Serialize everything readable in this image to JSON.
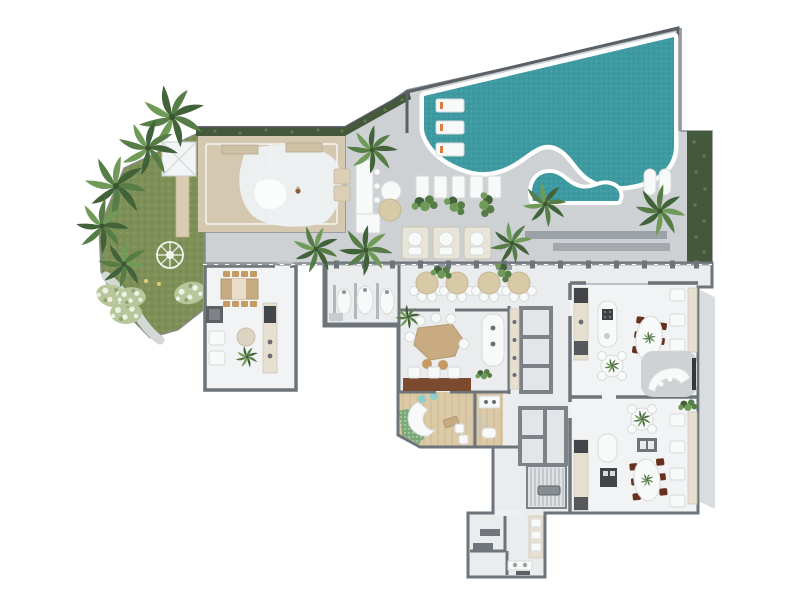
{
  "document": {
    "type": "architectural-floor-plan",
    "view": "top-down-render",
    "visible_text": "none"
  },
  "palette": {
    "background": "#ffffff",
    "deck": "#cdd1d4",
    "deck_line": "#878d93",
    "indoor_floor": "#eaeced",
    "room_floor": "#f1f3f4",
    "wall": "#6d747a",
    "wall_light": "#aab0b5",
    "pool_water": "#3e9aa1",
    "pool_deep": "#2f8a92",
    "coping": "#ffffff",
    "pool_wall": "#5a6066",
    "lawn": "#7e8f58",
    "lawn_light": "#93a467",
    "hedge": "#44593b",
    "hedge_light": "#5f7a4b",
    "palm_dark": "#42633a",
    "palm_mid": "#567d45",
    "palm_light": "#6f9a58",
    "court": "#d5c8b1",
    "court_line": "#f6f7f4",
    "blob": "#edf1f2",
    "blob_inner": "#fbfdfd",
    "wood_floor": "#dcc9a6",
    "plank": "#c2ae87",
    "wood_table": "#c8ab81",
    "timber": "#7c4b2f",
    "chair_tan": "#c59a63",
    "chair_brown": "#67311d",
    "umbrella": "#d9caa7",
    "white_furniture": "#f8f9f9",
    "furn_stroke": "#d7dadb",
    "counter_beige": "#e7e0d1",
    "appliance_dark": "#42464b",
    "appliance_mid": "#6a6f74",
    "mosaic_green": "#7aa978",
    "aqua": "#8bcfcd",
    "accent_orange": "#df7a3e",
    "path_gray": "#d4d8d5",
    "flower_light": "#eef2e4",
    "flower_green": "#b7c69b",
    "light_dot": "#e3cd6f",
    "gray_bench": "#9ba1a7",
    "balcony": "#dadde0",
    "core": "#7c8288",
    "cell": "#e3e6e8",
    "stair_line": "#aeb4b8"
  },
  "regions": [
    {
      "name": "swimming-pool"
    },
    {
      "name": "pool-lagoon"
    },
    {
      "name": "pool-deck"
    },
    {
      "name": "garden-lawn"
    },
    {
      "name": "sport-court"
    },
    {
      "name": "gazebo-canopy"
    },
    {
      "name": "compass-paving"
    },
    {
      "name": "flower-beds"
    },
    {
      "name": "hedge-top"
    },
    {
      "name": "hedge-right"
    },
    {
      "name": "party-room-left"
    },
    {
      "name": "poolside-washroom"
    },
    {
      "name": "outdoor-dining-terrace"
    },
    {
      "name": "coworking-room"
    },
    {
      "name": "bar-island"
    },
    {
      "name": "spa-salon"
    },
    {
      "name": "pantry-room"
    },
    {
      "name": "elevator-core-upper"
    },
    {
      "name": "elevator-core-lower"
    },
    {
      "name": "stairwell"
    },
    {
      "name": "corridor"
    },
    {
      "name": "gourmet-room-upper"
    },
    {
      "name": "gourmet-room-lower"
    },
    {
      "name": "tv-lounge-niche"
    },
    {
      "name": "restrooms"
    },
    {
      "name": "right-balcony"
    },
    {
      "name": "cabanas"
    },
    {
      "name": "sun-loungers"
    },
    {
      "name": "in-pool-loungers"
    },
    {
      "name": "outdoor-bar-counter"
    },
    {
      "name": "palm-trees"
    }
  ]
}
